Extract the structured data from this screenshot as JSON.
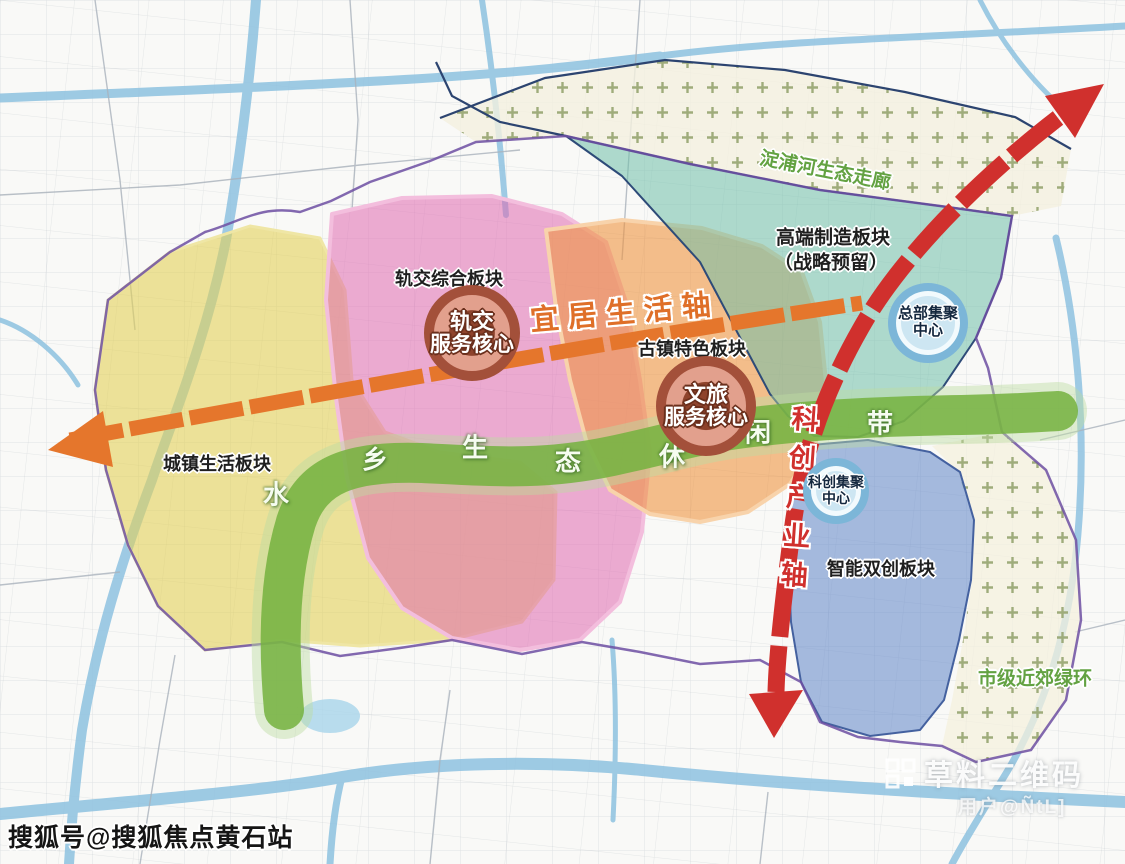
{
  "zones": {
    "rail_transit": "轨交综合板块",
    "ancient_town": "古镇特色板块",
    "high_end_manufacturing": "高端制造板块",
    "high_end_manufacturing_note": "（战略预留）",
    "town_life": "城镇生活板块",
    "smart_innovation": "智能双创板块",
    "suburban_green_ring": "市级近郊绿环",
    "dianpu_eco_corridor": "淀浦河生态走廊"
  },
  "cores": {
    "rail_service": {
      "line1": "轨交",
      "line2": "服务核心"
    },
    "culture_tourism_service": {
      "line1": "文旅",
      "line2": "服务核心"
    },
    "headquarters_cluster": {
      "line1": "总部集聚",
      "line2": "中心"
    },
    "scitech_cluster": {
      "line1": "科创集聚",
      "line2": "中心"
    }
  },
  "axes": {
    "livable_life_axis": "宜居生活轴",
    "scitech_industry_axis": "科创产业轴",
    "eco_belt_chars": [
      "水",
      "乡",
      "生",
      "态",
      "休",
      "闲",
      "带"
    ]
  },
  "watermarks": {
    "sohu": "搜狐号@搜狐焦点黄石站",
    "qr_service": "草料二维码",
    "qr_user": "用户@ÑtL]"
  },
  "colors": {
    "livable_axis": "#e5762c",
    "scitech_axis": "#d0302d",
    "eco_belt": "#74b13e",
    "rail_zone": "#e06ab0",
    "ancient_zone": "#ef9441",
    "manufacturing_zone": "#6fbfa9",
    "town_zone": "#e2d158",
    "innovation_zone": "#6b8dcb",
    "river": "#8ec2e0",
    "boundary": "#6d4fa2"
  }
}
